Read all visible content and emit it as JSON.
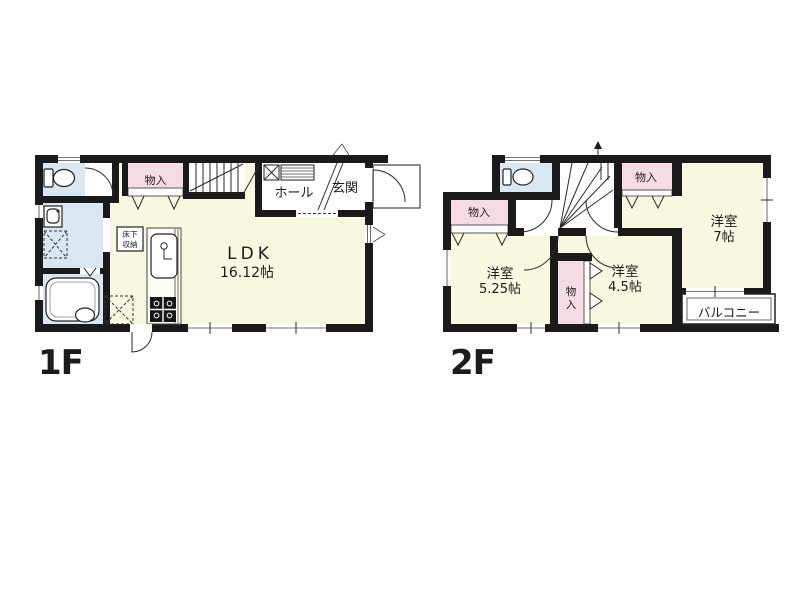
{
  "colors": {
    "wall": "#1a1a1a",
    "room_floor": "#faf7e1",
    "closet_pink": "#f7dbe4",
    "wet_area_blue": "#d9e7f3",
    "balcony_white": "#ffffff",
    "porch_outline": "#666666"
  },
  "floor1": {
    "label": "1F",
    "rooms": {
      "ldk": {
        "name": "LDK",
        "size": "16.12帖"
      },
      "hall": {
        "name": "ホール"
      },
      "entrance": {
        "name": "玄関"
      },
      "closet": {
        "name": "物入"
      },
      "underfloor": {
        "line1": "床下",
        "line2": "収納"
      }
    }
  },
  "floor2": {
    "label": "2F",
    "rooms": {
      "western_7": {
        "name": "洋室",
        "size": "7帖"
      },
      "western_525": {
        "name": "洋室",
        "size": "5.25帖"
      },
      "western_45": {
        "name": "洋室",
        "size": "4.5帖"
      },
      "closet_left": {
        "name": "物入"
      },
      "closet_top": {
        "name": "物入"
      },
      "closet_center": {
        "chars": [
          "物",
          "入"
        ]
      },
      "balcony": {
        "name": "バルコニー"
      }
    }
  }
}
